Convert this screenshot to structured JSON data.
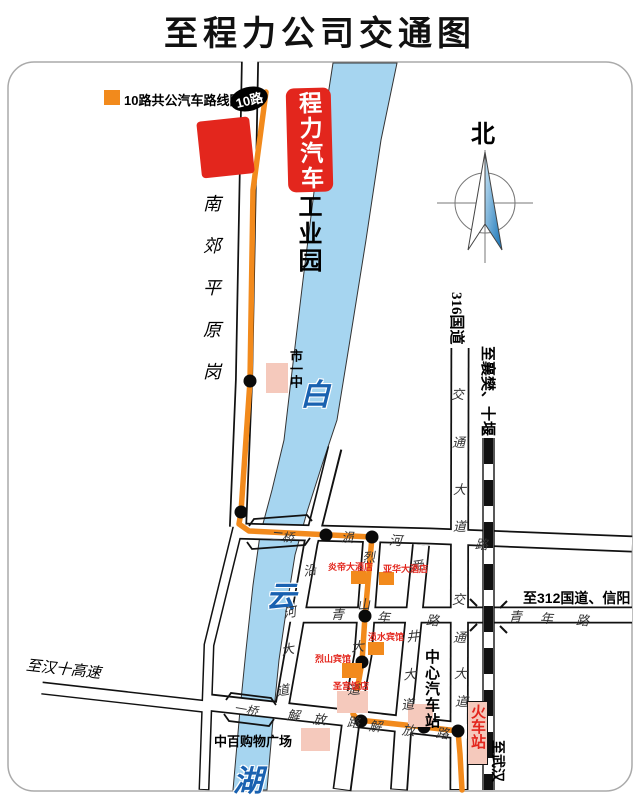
{
  "title": "至程力公司交通图",
  "legend": {
    "label": "10路共公汽车路线图",
    "badge": "10路"
  },
  "company": {
    "box_label": "程力汽车",
    "park_label": "工业园"
  },
  "compass_label": "北",
  "areas": {
    "nanjiao": "南郊平原岗",
    "shiyizhong": "市一中"
  },
  "river_chars": [
    "白",
    "云",
    "湖"
  ],
  "roads": {
    "g316": "316国道",
    "jiaotong_n": [
      "交",
      "通",
      "大",
      "道"
    ],
    "jiaotong_s": [
      "交",
      "通",
      "大",
      "道"
    ],
    "qingnian_w": [
      "青",
      "年",
      "路"
    ],
    "qingnian_e": [
      "青",
      "年",
      "路"
    ],
    "erqiao_road": [
      "涢",
      "河",
      "路"
    ],
    "lieshan": [
      "烈",
      "山",
      "大",
      "道"
    ],
    "shunjing": [
      "舜",
      "井",
      "大",
      "道"
    ],
    "yanhe": [
      "沿",
      "河",
      "大",
      "道"
    ],
    "jiefang_w": [
      "解",
      "放",
      "路"
    ],
    "jiefang_e": [
      "解",
      "放",
      "路"
    ],
    "bridge_2": "二桥",
    "bridge_1": "一桥"
  },
  "destinations": {
    "xiangfan": "至襄樊、十堰",
    "g312": "至312国道、信阳",
    "hanshi": "至汉十高速",
    "wuhan": "至武汉"
  },
  "stations": {
    "bus_center": "中心汽车站",
    "railway": "火车站"
  },
  "pois": {
    "yandi": "炎帝大酒店",
    "yahua": "亚华大酒店",
    "yunshui": "涢水宾馆",
    "lieshan": "烈山宾馆",
    "shenggong": "圣宫饭店",
    "zhongbai": "中百购物广场"
  },
  "colors": {
    "route": "#F28A1C",
    "river": "#A6D5F0",
    "red": "#E3261D",
    "pink": "#F5C9BC",
    "rail": "#111111",
    "river_text": "#1961B0"
  }
}
